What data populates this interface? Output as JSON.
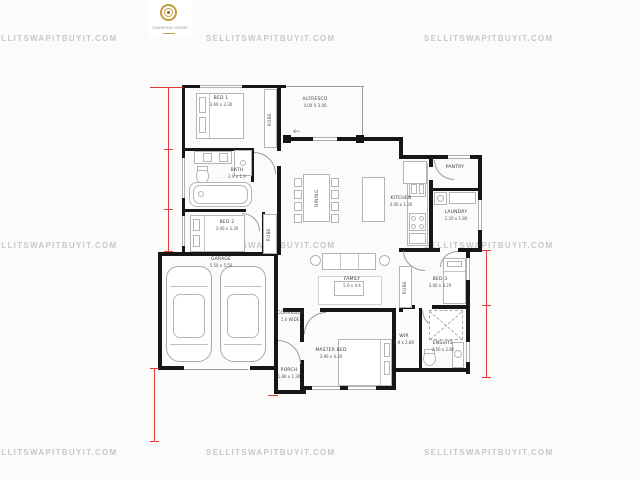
{
  "watermark": {
    "text": "SELLITSWAPITBUYIT.COM",
    "color": "#c8c8c8"
  },
  "logo": {
    "brand": "CHAMPION GROUP"
  },
  "colors": {
    "wall": "#161616",
    "dimension_red": "#e23b3b",
    "furniture_gray": "#b5b5b5",
    "label_text": "#3a3a3a",
    "logo_gold": "#c49a3e",
    "watermark_gray": "#c8c8c8"
  },
  "rooms": {
    "bed1": {
      "name": "BED 1",
      "dims": "3.60 x 3.30"
    },
    "alfresco": {
      "name": "ALFRESCO",
      "dims": "4.00 X 3.00"
    },
    "bath": {
      "name": "BATH",
      "dims": "2.9 x 1.9"
    },
    "bed2": {
      "name": "BED 2",
      "dims": "3.00 x 3.30"
    },
    "garage": {
      "name": "GARAGE",
      "dims": "5.50 x 5.50"
    },
    "dining": {
      "name": "DINING"
    },
    "kitchen": {
      "name": "KITCHEN",
      "dims": "3.00 x 1.30"
    },
    "pantry": {
      "name": "PANTRY"
    },
    "laundry": {
      "name": "LAUNDRY",
      "dims": "2.20 x 1.80"
    },
    "family": {
      "name": "FAMILY",
      "dims": "5.0 x 4.4"
    },
    "corridor": {
      "name": "CORRIDOR",
      "dims": "1.4 WIDE"
    },
    "master": {
      "name": "MASTER BED",
      "dims": "3.90 x 4.20"
    },
    "wir": {
      "name": "WIR",
      "dims": "1.9 x 2.80"
    },
    "ensuite": {
      "name": "ENSUITE",
      "dims": "2.50 x 2.80"
    },
    "bed3": {
      "name": "BED 3",
      "dims": "3.00 x 3.20"
    },
    "porch": {
      "name": "PORCH",
      "dims": "1.80 x 1.30"
    },
    "robe": {
      "name": "ROBE"
    }
  }
}
